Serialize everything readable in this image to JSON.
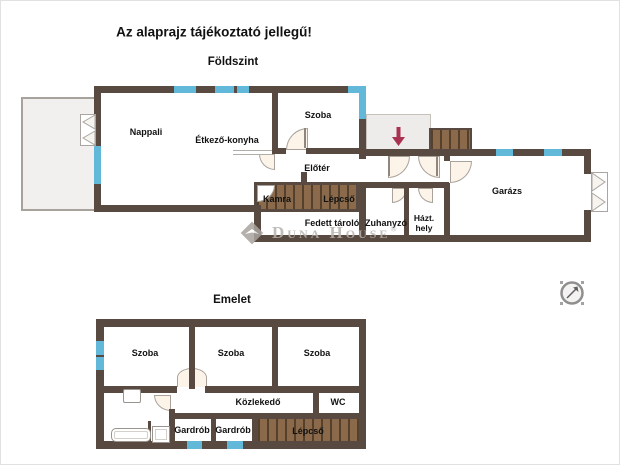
{
  "title": "Az alaprajz tájékoztató jellegű!",
  "floors": {
    "ground": {
      "name": "Földszint",
      "rooms": {
        "nappali": "Nappali",
        "etkezo_konyha": "Étkező-konyha",
        "szoba": "Szoba",
        "eloter": "Előtér",
        "kamra": "Kamra",
        "lepcso": "Lépcső",
        "fedett_tarolo": "Fedett tároló",
        "zuhanyzo": "Zuhanyzó",
        "hazt_line1": "Házt.",
        "hazt_line2": "hely",
        "garazs": "Garázs"
      }
    },
    "upper": {
      "name": "Emelet",
      "rooms": {
        "szoba1": "Szoba",
        "szoba2": "Szoba",
        "szoba3": "Szoba",
        "kozlekedo": "Közlekedő",
        "wc": "WC",
        "gardrob1": "Gardrób",
        "gardrob2": "Gardrób",
        "lepcso": "Lépcső"
      }
    }
  },
  "watermark": {
    "brand": "Duna House",
    "registered": "®"
  },
  "icons": {
    "entrance_arrow": "entrance-direction-arrow",
    "compass": "compass-rose",
    "french_door": "double-french-door",
    "garage_door": "garage-double-door"
  },
  "colors": {
    "wall": "#594a41",
    "window": "#62b8d8",
    "stairs": "#8a6a4a",
    "stairs_line": "#55402c",
    "terrace": "#f2f0ee",
    "porch": "#eeeceb",
    "door_fill": "#fdf4e9",
    "arrow": "#a83250",
    "watermark": "#b7b2ad"
  }
}
